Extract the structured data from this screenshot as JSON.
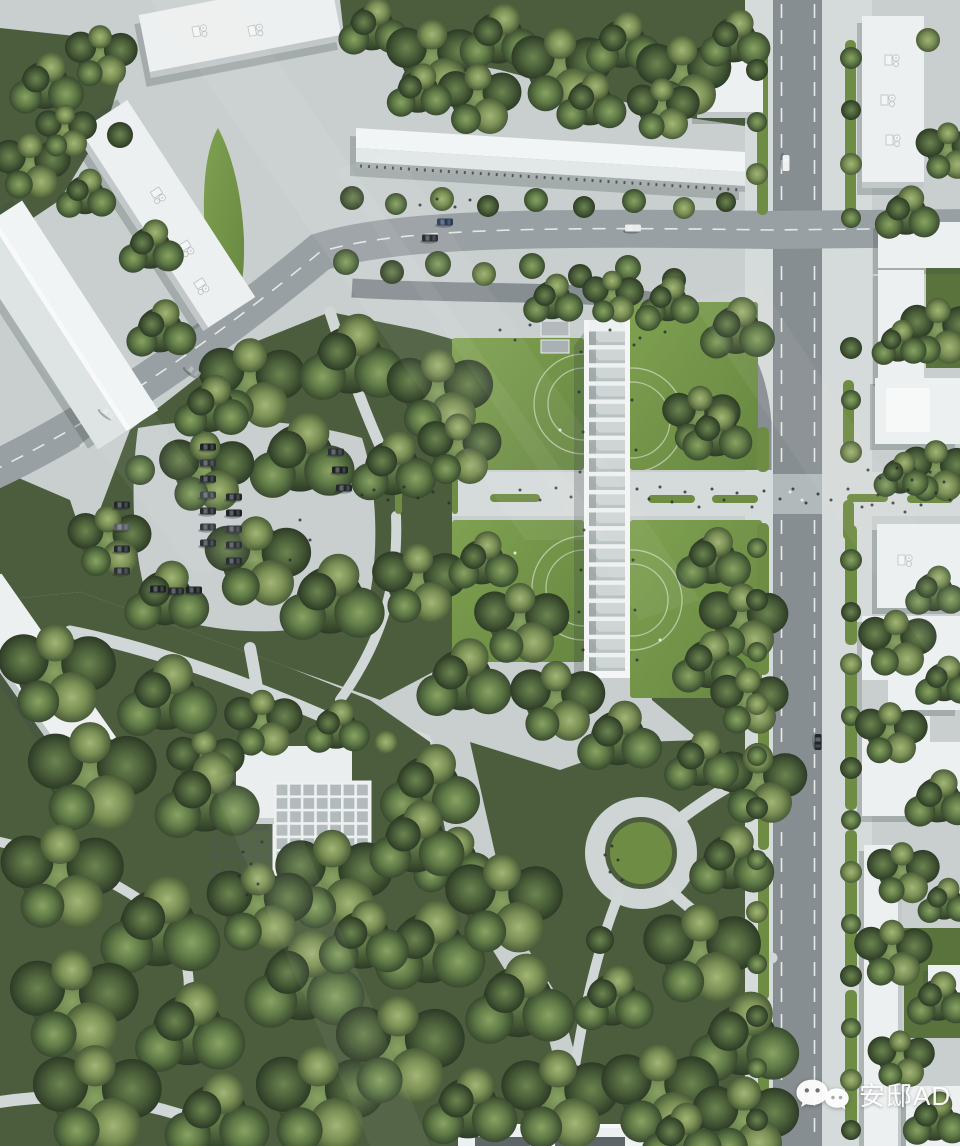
{
  "watermark": {
    "icon": "wechat-icon",
    "label": "安邸AD"
  },
  "palette": {
    "pavement": "#c9cfcf",
    "pavement-light": "#d5dbda",
    "grass": "#6f8c45",
    "grass-bright": "#82a051",
    "grass-dark": "#5a733c",
    "forest": "#4c5d3e",
    "road": "#99a0a3",
    "road-dark": "#878e91",
    "building": "#edf0f0",
    "building-edge": "#c2c8c9",
    "glass": "#b7bfc0",
    "marking": "#f1f3f2",
    "walkway": "#d0d7d6",
    "person": "#272e31",
    "car-dark": "#22262b",
    "watermark": "#ffffff"
  }
}
